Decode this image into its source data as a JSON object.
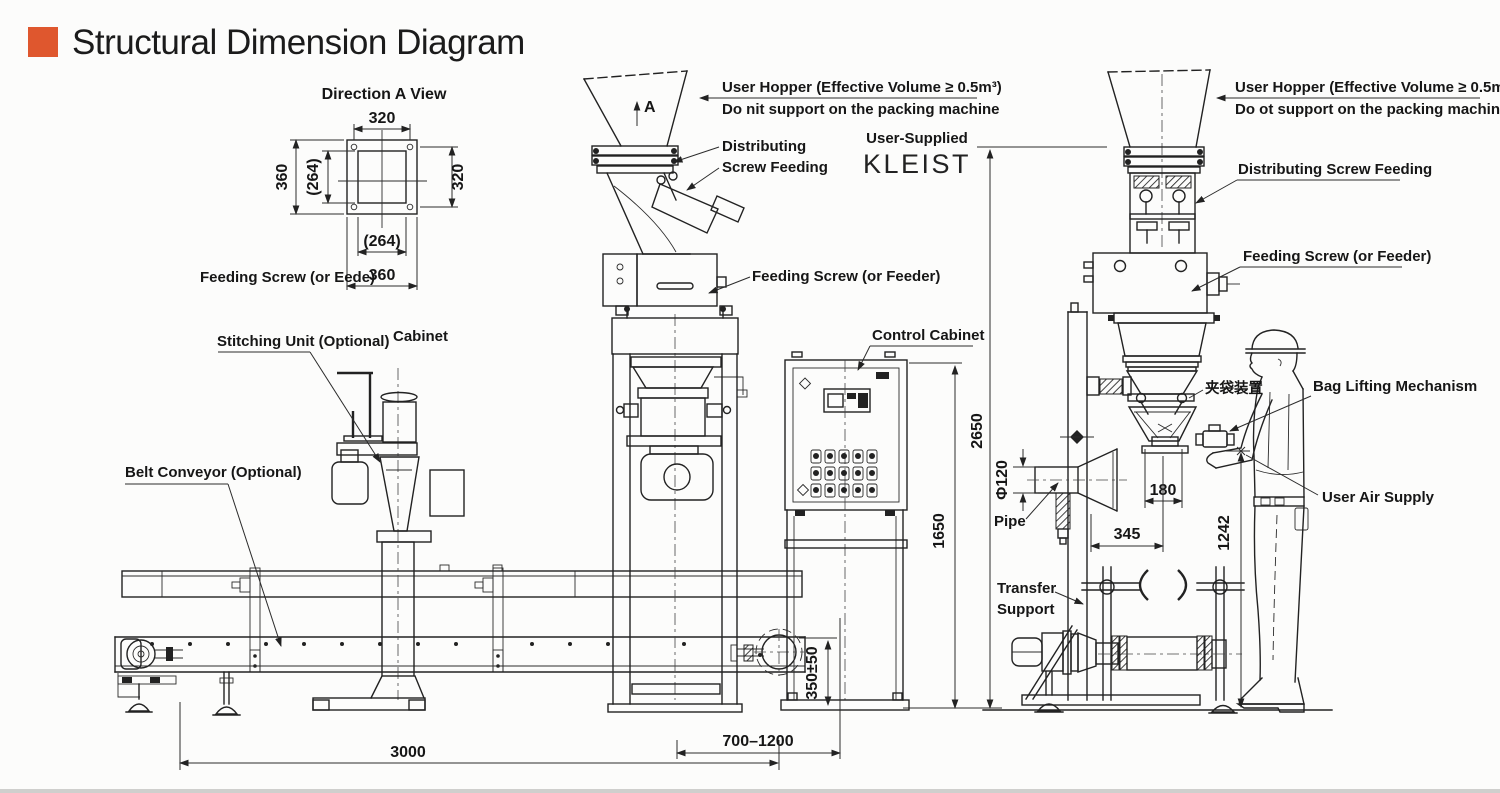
{
  "header": {
    "title": "Structural Dimension Diagram"
  },
  "detail_view": {
    "title": "Direction A View",
    "dim_top": "320",
    "dim_left_outer": "360",
    "dim_left_inner": "(264)",
    "dim_right": "320",
    "dim_bottom_inner": "(264)",
    "dim_bottom_outer": "360",
    "caption": "Feeding Screw (or Eede)"
  },
  "center_machine": {
    "view_arrow": "A",
    "user_hopper_line1": "User Hopper (Effective Volume ≥ 0.5m³)",
    "user_hopper_line2": "Do nit support on the packing machine",
    "distributing_line1": "Distributing",
    "distributing_line2": "Screw Feeding",
    "user_supplied": "User-Supplied",
    "user_supplied_name": "KLEIST",
    "feeding_screw": "Feeding Screw (or Feeder)",
    "stitching_unit": "Stitching Unit (Optional)",
    "cabinet": "Cabinet",
    "belt_conveyor": "Belt Conveyor (Optional)",
    "control_cabinet": "Control Cabinet"
  },
  "right_machine": {
    "user_hopper_line1": "User Hopper (Effective Volume ≥ 0.5m³)",
    "user_hopper_line2": "Do ot support on the packing machine",
    "distributing_screw": "Distributing Screw Feeding",
    "feeding_screw": "Feeding Screw (or Feeder)",
    "bag_clamp_cn": "夹袋装置",
    "bag_lifting": "Bag Lifting Mechanism",
    "user_air_supply": "User Air Supply",
    "pipe": "Pipe",
    "transfer_line1": "Transfer",
    "transfer_line2": "Support"
  },
  "dimensions": {
    "overall_height": "2650",
    "control_cabinet_height": "1650",
    "pipe_diameter": "Φ120",
    "bag_spout_width": "180",
    "pipe_offset": "345",
    "operating_height": "1242",
    "discharge_height": "350±50",
    "conveyor_length": "3000",
    "conveyor_position_range": "700–1200"
  },
  "colors": {
    "accent": "#DF572E",
    "line": "#222222"
  }
}
